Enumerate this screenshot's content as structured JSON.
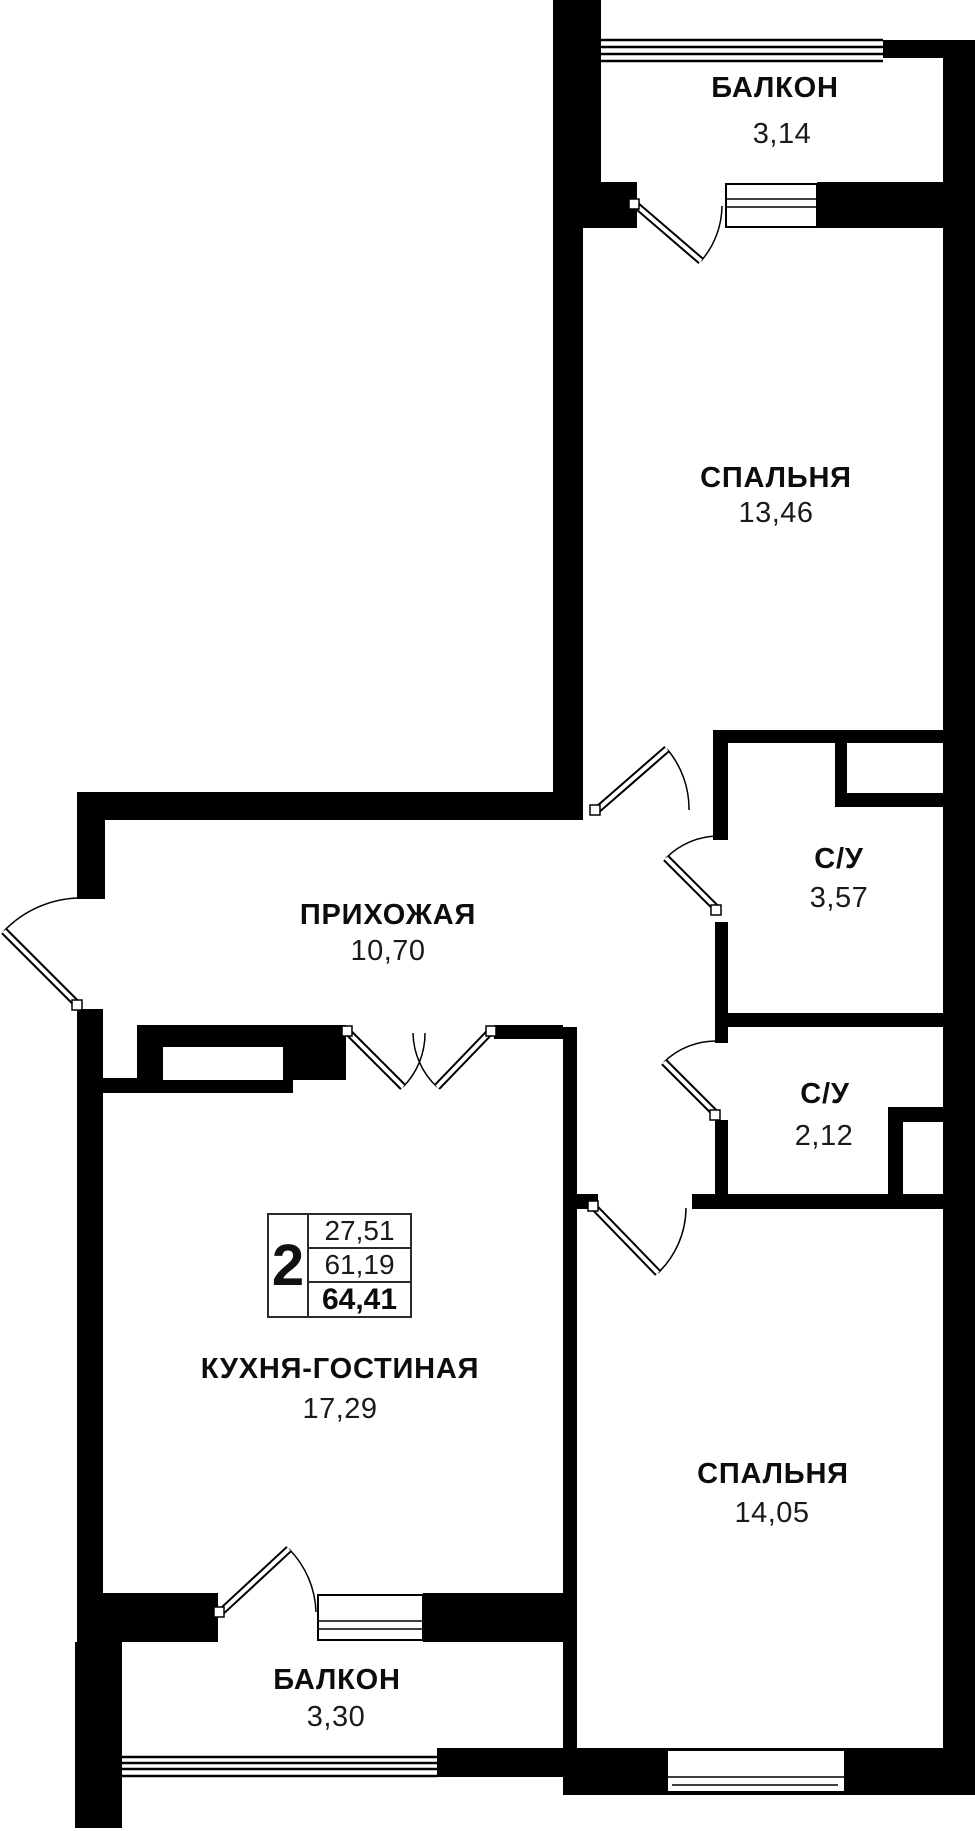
{
  "plan": {
    "title": "2-room apartment floor plan",
    "rooms": [
      {
        "id": "balcony-top",
        "name": "БАЛКОН",
        "area": "3,14"
      },
      {
        "id": "bedroom-top",
        "name": "СПАЛЬНЯ",
        "area": "13,46"
      },
      {
        "id": "hallway",
        "name": "ПРИХОЖАЯ",
        "area": "10,70"
      },
      {
        "id": "bathroom-1",
        "name": "С/У",
        "area": "3,57"
      },
      {
        "id": "bathroom-2",
        "name": "С/У",
        "area": "2,12"
      },
      {
        "id": "kitchen-living",
        "name": "КУХНЯ-ГОСТИНАЯ",
        "area": "17,29"
      },
      {
        "id": "bedroom-bottom",
        "name": "СПАЛЬНЯ",
        "area": "14,05"
      },
      {
        "id": "balcony-bottom",
        "name": "БАЛКОН",
        "area": "3,30"
      }
    ],
    "legend": {
      "rooms_count": "2",
      "living_area": "27,51",
      "area_no_balcony": "61,19",
      "total_area": "64,41"
    },
    "colors": {
      "wall": "#000000",
      "background": "#ffffff",
      "text": "#111111"
    }
  }
}
